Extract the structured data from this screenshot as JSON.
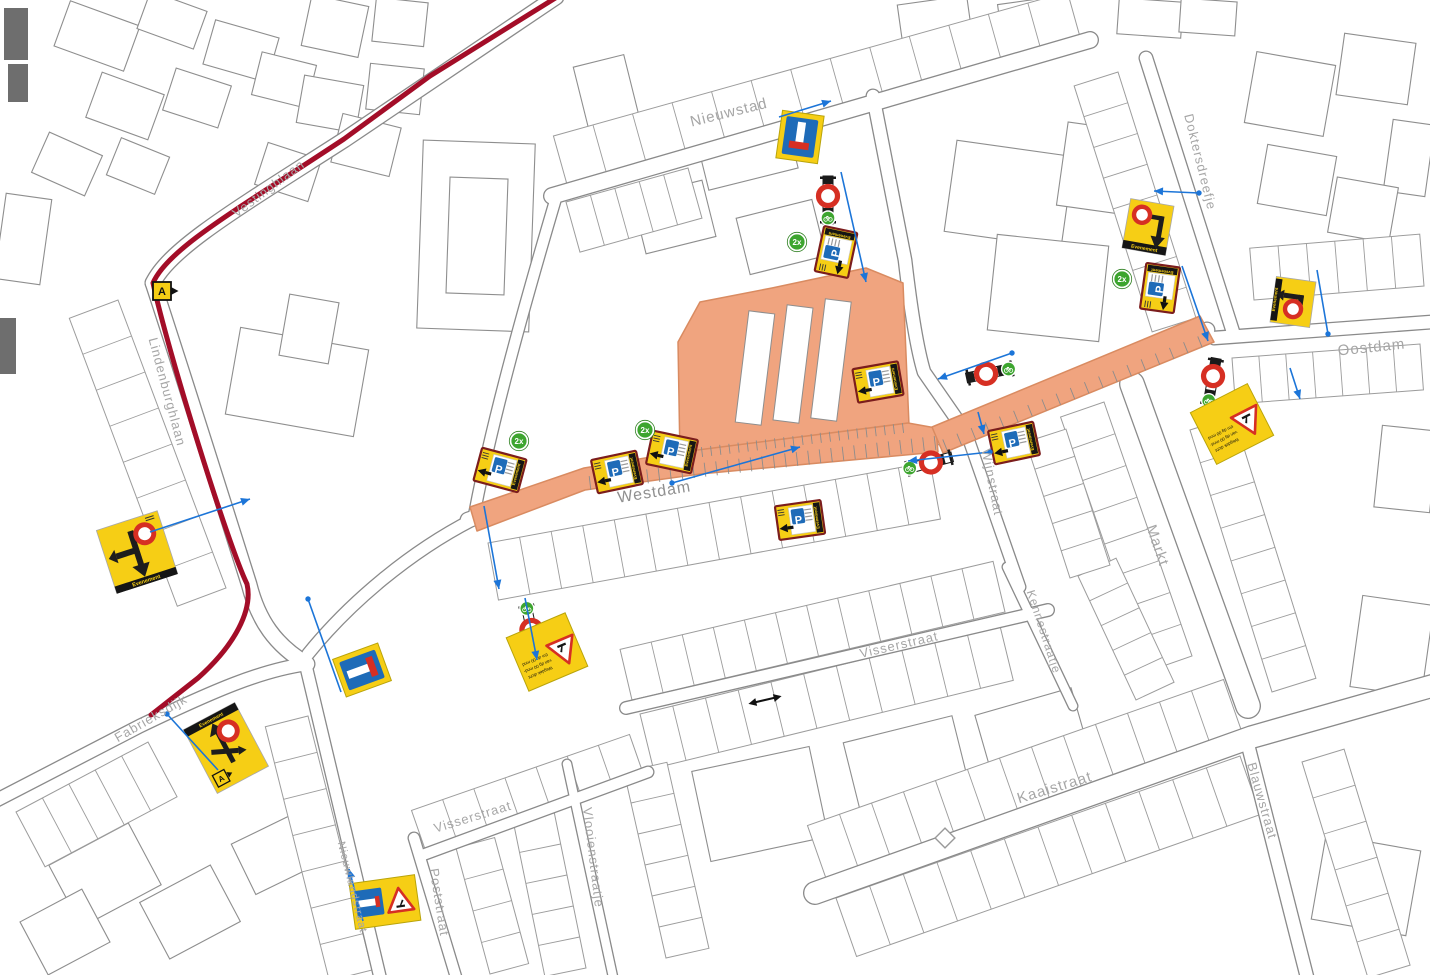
{
  "colors": {
    "background": "#ffffff",
    "building_stroke": "#8e8e8e",
    "parcel_stroke": "#9c9c9c",
    "street_casing": "#8a8a8a",
    "street_fill": "#ffffff",
    "label_gray": "#a6a6a6",
    "label_dark": "#8f8f8f",
    "work_zone_fill": "#f0a47f",
    "work_zone_stroke": "#d98b61",
    "route_red": "#a30d28",
    "sign_yellow": "#f6ce15",
    "sign_border_darkred": "#7b1d1d",
    "sign_blue": "#1e6bb8",
    "closed_red": "#d62f23",
    "badge_green": "#3da52f",
    "connector_blue": "#1c75d8",
    "filled_building": "#6e6e6e",
    "sign_black": "#1d1d1d"
  },
  "sign_text": {
    "evenement": "Evenement",
    "parking": "P",
    "route_marker": "A",
    "count": "2x",
    "roadworks_lines": [
      "Wegdek dicht",
      "van dg 00 mnd-",
      "t/m dg 00 mnd"
    ]
  },
  "street_labels": [
    {
      "name": "Nieuwstad",
      "x": 730,
      "y": 117,
      "rot": -14,
      "size": 15
    },
    {
      "name": "Doktersdreefje",
      "x": 1196,
      "y": 163,
      "rot": 76,
      "size": 13
    },
    {
      "name": "Oostdam",
      "x": 1372,
      "y": 352,
      "rot": -6,
      "size": 15
    },
    {
      "name": "Westdam",
      "x": 655,
      "y": 497,
      "rot": -9,
      "size": 16,
      "color": "#8f8f8f"
    },
    {
      "name": "Wijnstraat",
      "x": 988,
      "y": 483,
      "rot": 79,
      "size": 13
    },
    {
      "name": "Markt",
      "x": 1153,
      "y": 547,
      "rot": 71,
      "size": 15
    },
    {
      "name": "Kennestraatje",
      "x": 1040,
      "y": 633,
      "rot": 72,
      "size": 12
    },
    {
      "name": "Visserstraat",
      "x": 900,
      "y": 649,
      "rot": -13,
      "size": 13
    },
    {
      "name": "Visserstraat",
      "x": 474,
      "y": 821,
      "rot": -17,
      "size": 13
    },
    {
      "name": "Vlooienstraatje",
      "x": 589,
      "y": 858,
      "rot": 83,
      "size": 13
    },
    {
      "name": "Kaaistraat",
      "x": 1056,
      "y": 792,
      "rot": -17,
      "size": 15
    },
    {
      "name": "Blauwstraat",
      "x": 1258,
      "y": 802,
      "rot": 74,
      "size": 13
    },
    {
      "name": "Poststraat",
      "x": 435,
      "y": 903,
      "rot": 81,
      "size": 13
    },
    {
      "name": "Nieuwlandstraat",
      "x": 349,
      "y": 888,
      "rot": 76,
      "size": 11
    },
    {
      "name": "Lindenburghlaan",
      "x": 163,
      "y": 393,
      "rot": 75,
      "size": 13
    },
    {
      "name": "Vestinghlaan",
      "x": 271,
      "y": 192,
      "rot": -37,
      "size": 13
    },
    {
      "name": "Fabrieksdijk",
      "x": 153,
      "y": 722,
      "rot": -30,
      "size": 13
    }
  ],
  "signs": [
    {
      "type": "dead_end_v",
      "x": 800,
      "y": 137,
      "rot": 8
    },
    {
      "type": "p_event",
      "x": 836,
      "y": 252,
      "rot": -78
    },
    {
      "type": "detour_down",
      "x": 1148,
      "y": 227,
      "rot": 10
    },
    {
      "type": "p_event",
      "x": 1160,
      "y": 288,
      "rot": -82
    },
    {
      "type": "detour_left",
      "x": 1293,
      "y": 302,
      "rot": 8
    },
    {
      "type": "roadworks_text",
      "x": 1232,
      "y": 424,
      "rot": 153
    },
    {
      "type": "p_event",
      "x": 1014,
      "y": 443,
      "rot": -12
    },
    {
      "type": "p_event",
      "x": 878,
      "y": 382,
      "rot": -10
    },
    {
      "type": "p_event",
      "x": 800,
      "y": 520,
      "rot": -8
    },
    {
      "type": "p_event",
      "x": 500,
      "y": 470,
      "rot": 15
    },
    {
      "type": "p_event",
      "x": 617,
      "y": 472,
      "rot": -12
    },
    {
      "type": "p_event",
      "x": 672,
      "y": 452,
      "rot": 12
    },
    {
      "type": "roadworks_text",
      "x": 547,
      "y": 652,
      "rot": 157
    },
    {
      "type": "detour_left_down",
      "x": 137,
      "y": 552,
      "rot": -18
    },
    {
      "type": "route_a",
      "x": 162,
      "y": 291,
      "rot": 0
    },
    {
      "type": "detour_cross",
      "x": 226,
      "y": 748,
      "rot": -28
    },
    {
      "type": "dead_end_h",
      "x": 362,
      "y": 670,
      "rot": -20
    },
    {
      "type": "roadworks_deadend",
      "x": 385,
      "y": 902,
      "rot": -8
    }
  ],
  "barriers": [
    {
      "x": 828,
      "y": 200,
      "rot": 90,
      "c1": -4,
      "bike": 18
    },
    {
      "x": 1212,
      "y": 382,
      "rot": 100,
      "c1": -6,
      "bike": 19
    },
    {
      "x": 990,
      "y": 373,
      "rot": -12,
      "c1": -4,
      "bike": 19
    },
    {
      "x": 929,
      "y": 463,
      "rot": -15,
      "c1": 2,
      "bike": -20
    },
    {
      "x": 531,
      "y": 628,
      "rot": 78,
      "c1": 2,
      "bike": -20
    }
  ],
  "count_badges": [
    [
      797,
      242
    ],
    [
      1122,
      279
    ],
    [
      519,
      441
    ],
    [
      645,
      430
    ]
  ],
  "route": {
    "path": "M 557,-3 L 430,76 L 344,139 C 240,208 168,248 153,283 C 168,352 228,545 247,584 C 253,610 235,645 198,678 L 151,715"
  },
  "work_zone": {
    "polys": [
      "M 678,342 L 700,302 L 772,288 L 866,268 L 903,283 L 909,425 L 680,458 Z",
      "M 470,507 L 584,468 L 682,452 L 908,423 L 936,428 L 938,452 L 700,474 L 585,490 L 477,531 Z",
      "M 932,427 L 1200,316 L 1214,342 L 943,453 Z"
    ],
    "cutouts": [
      [
        742,
        312,
        26,
        112,
        7
      ],
      [
        780,
        306,
        26,
        116,
        7
      ],
      [
        818,
        300,
        26,
        120,
        7
      ]
    ],
    "ticks": [
      [
        590,
        483,
        935,
        443,
        30,
        14
      ],
      [
        702,
        452,
        903,
        428,
        22,
        10
      ],
      [
        945,
        445,
        1200,
        342,
        18,
        12
      ]
    ]
  },
  "streets": [
    {
      "d": "M 552,196 L 1090,40",
      "w": 18
    },
    {
      "d": "M 873,96 L 905,260 C 912,320 918,352 924,372 L 967,434",
      "w": 15
    },
    {
      "d": "M 1146,58 L 1233,332",
      "w": 15
    },
    {
      "d": "M 1214,338 L 1432,322",
      "w": 15
    },
    {
      "d": "M 966,432 L 1020,587",
      "w": 13
    },
    {
      "d": "M 1132,384 L 1248,706",
      "w": 26
    },
    {
      "d": "M 1007,567 L 1073,706",
      "w": 11
    },
    {
      "d": "M 626,708 L 1048,610",
      "w": 14
    },
    {
      "d": "M 815,893 L 1252,737 L 1432,686",
      "w": 24
    },
    {
      "d": "M 1247,741 L 1307,977",
      "w": 15
    },
    {
      "d": "M 414,838 L 456,977",
      "w": 13
    },
    {
      "d": "M 567,764 L 613,977",
      "w": 11
    },
    {
      "d": "M 305,662 L 380,977",
      "w": 14
    },
    {
      "d": "M 420,856 L 648,772",
      "w": 13
    },
    {
      "d": "M 153,283 C 185,380 235,540 249,584 C 258,620 275,645 307,664",
      "w": 17
    },
    {
      "d": "M -3,800 L 140,726 C 215,690 262,670 307,664",
      "w": 15
    },
    {
      "d": "M 556,-3 L 344,140 C 238,208 170,248 153,283",
      "w": 17
    },
    {
      "d": "M 468,520 L 585,480 L 700,464 L 934,438 L 1207,330",
      "w": 17
    },
    {
      "d": "M 556,198 C 520,320 490,430 474,516",
      "w": 13
    },
    {
      "d": "M 472,520 C 410,552 350,602 308,654",
      "w": 14
    }
  ],
  "parcels": [
    [
      632,
      700,
      1005,
      612,
      -52,
      12
    ],
    [
      640,
      714,
      1000,
      626,
      56,
      11
    ],
    [
      828,
      884,
      1244,
      738,
      -62,
      13
    ],
    [
      836,
      898,
      1240,
      756,
      62,
      12
    ],
    [
      488,
      543,
      930,
      462,
      58,
      14
    ],
    [
      568,
      188,
      1082,
      44,
      -54,
      13
    ],
    [
      1104,
      402,
      1192,
      656,
      46,
      8
    ],
    [
      1190,
      430,
      1272,
      692,
      -46,
      8
    ],
    [
      118,
      300,
      226,
      588,
      52,
      8
    ],
    [
      1302,
      762,
      1368,
      978,
      -44,
      6
    ],
    [
      548,
      782,
      586,
      968,
      42,
      6
    ],
    [
      624,
      772,
      666,
      958,
      -44,
      6
    ],
    [
      16,
      812,
      148,
      742,
      62,
      5
    ],
    [
      1232,
      358,
      1420,
      344,
      46,
      7
    ],
    [
      1254,
      300,
      1424,
      286,
      -52,
      6
    ],
    [
      426,
      852,
      644,
      776,
      -44,
      7
    ],
    [
      308,
      716,
      372,
      970,
      44,
      7
    ],
    [
      456,
      848,
      490,
      974,
      -40,
      4
    ],
    [
      1078,
      576,
      1136,
      700,
      -42,
      5
    ],
    [
      566,
      202,
      688,
      168,
      52,
      5
    ],
    [
      1118,
      72,
      1196,
      318,
      46,
      8
    ],
    [
      1026,
      442,
      1070,
      578,
      -42,
      5
    ]
  ],
  "buildings": [
    [
      420,
      142,
      112,
      188,
      2
    ],
    [
      448,
      178,
      58,
      116,
      2
    ],
    [
      232,
      338,
      130,
      88,
      10
    ],
    [
      284,
      298,
      50,
      62,
      10
    ],
    [
      950,
      148,
      118,
      92,
      8
    ],
    [
      992,
      240,
      112,
      96,
      6
    ],
    [
      1062,
      126,
      64,
      84,
      8
    ],
    [
      700,
      118,
      92,
      62,
      -14
    ],
    [
      638,
      188,
      72,
      58,
      -14
    ],
    [
      742,
      208,
      78,
      58,
      -14
    ],
    [
      60,
      12,
      74,
      48,
      20
    ],
    [
      142,
      0,
      60,
      40,
      20
    ],
    [
      208,
      28,
      66,
      46,
      16
    ],
    [
      92,
      82,
      66,
      48,
      20
    ],
    [
      168,
      76,
      58,
      44,
      18
    ],
    [
      256,
      58,
      56,
      44,
      14
    ],
    [
      38,
      142,
      58,
      44,
      24
    ],
    [
      112,
      146,
      52,
      40,
      22
    ],
    [
      306,
      0,
      58,
      52,
      12
    ],
    [
      374,
      0,
      52,
      44,
      6
    ],
    [
      300,
      80,
      60,
      48,
      10
    ],
    [
      368,
      66,
      54,
      46,
      6
    ],
    [
      336,
      120,
      60,
      50,
      14
    ],
    [
      260,
      150,
      56,
      44,
      18
    ],
    [
      580,
      60,
      52,
      62,
      -14
    ],
    [
      614,
      118,
      46,
      54,
      -14
    ],
    [
      0,
      196,
      46,
      86,
      8
    ],
    [
      60,
      840,
      90,
      70,
      -28
    ],
    [
      150,
      880,
      80,
      64,
      -28
    ],
    [
      30,
      902,
      70,
      60,
      -28
    ],
    [
      240,
      826,
      70,
      56,
      -26
    ],
    [
      1318,
      842,
      96,
      86,
      10
    ],
    [
      1356,
      600,
      72,
      92,
      8
    ],
    [
      1378,
      428,
      56,
      82,
      6
    ],
    [
      700,
      758,
      120,
      92,
      -12
    ],
    [
      852,
      728,
      112,
      86,
      -14
    ],
    [
      984,
      700,
      100,
      80,
      -16
    ],
    [
      1250,
      58,
      80,
      72,
      10
    ],
    [
      1340,
      38,
      72,
      62,
      8
    ],
    [
      1388,
      122,
      42,
      72,
      8
    ],
    [
      1262,
      150,
      70,
      60,
      10
    ],
    [
      1332,
      182,
      62,
      56,
      10
    ],
    [
      1118,
      0,
      64,
      36,
      4
    ],
    [
      900,
      0,
      70,
      44,
      -8
    ],
    [
      1000,
      0,
      64,
      40,
      -8
    ],
    [
      1180,
      0,
      56,
      34,
      4
    ]
  ],
  "filled_buildings": [
    [
      4,
      8,
      24,
      52
    ],
    [
      8,
      64,
      20,
      38
    ],
    [
      0,
      318,
      16,
      56
    ]
  ],
  "connectors": [
    {
      "x1": 779,
      "y1": 117,
      "x2": 831,
      "y2": 101,
      "dot": null,
      "arrow": "end"
    },
    {
      "x1": 841,
      "y1": 172,
      "x2": 866,
      "y2": 282,
      "dot": null,
      "arrow": "end"
    },
    {
      "x1": 1199,
      "y1": 193,
      "x2": 1154,
      "y2": 191,
      "dot": "start",
      "arrow": "end"
    },
    {
      "x1": 1182,
      "y1": 266,
      "x2": 1208,
      "y2": 341,
      "dot": null,
      "arrow": "end"
    },
    {
      "x1": 1317,
      "y1": 270,
      "x2": 1328,
      "y2": 334,
      "dot": "end",
      "arrow": null
    },
    {
      "x1": 1290,
      "y1": 368,
      "x2": 1300,
      "y2": 399,
      "dot": null,
      "arrow": "end"
    },
    {
      "x1": 1012,
      "y1": 353,
      "x2": 938,
      "y2": 379,
      "dot": "start",
      "arrow": "end"
    },
    {
      "x1": 990,
      "y1": 452,
      "x2": 908,
      "y2": 461,
      "dot": "start",
      "arrow": "end"
    },
    {
      "x1": 672,
      "y1": 483,
      "x2": 800,
      "y2": 447,
      "dot": "start",
      "arrow": "end"
    },
    {
      "x1": 484,
      "y1": 506,
      "x2": 499,
      "y2": 589,
      "dot": null,
      "arrow": "end"
    },
    {
      "x1": 525,
      "y1": 598,
      "x2": 537,
      "y2": 660,
      "dot": null,
      "arrow": "end"
    },
    {
      "x1": 150,
      "y1": 532,
      "x2": 250,
      "y2": 499,
      "dot": null,
      "arrow": "end"
    },
    {
      "x1": 167,
      "y1": 714,
      "x2": 218,
      "y2": 770,
      "dot": "start",
      "arrow": null
    },
    {
      "x1": 308,
      "y1": 599,
      "x2": 341,
      "y2": 692,
      "dot": "start",
      "arrow": null
    },
    {
      "x1": 363,
      "y1": 921,
      "x2": 349,
      "y2": 869,
      "dot": null,
      "arrow": "end"
    },
    {
      "x1": 978,
      "y1": 412,
      "x2": 984,
      "y2": 434,
      "dot": null,
      "arrow": "end"
    }
  ],
  "misc": {
    "double_arrow": {
      "x": 765,
      "y": 700,
      "rot": -13,
      "len": 34
    },
    "diamond": {
      "x": 945,
      "y": 838,
      "r": 7
    }
  }
}
